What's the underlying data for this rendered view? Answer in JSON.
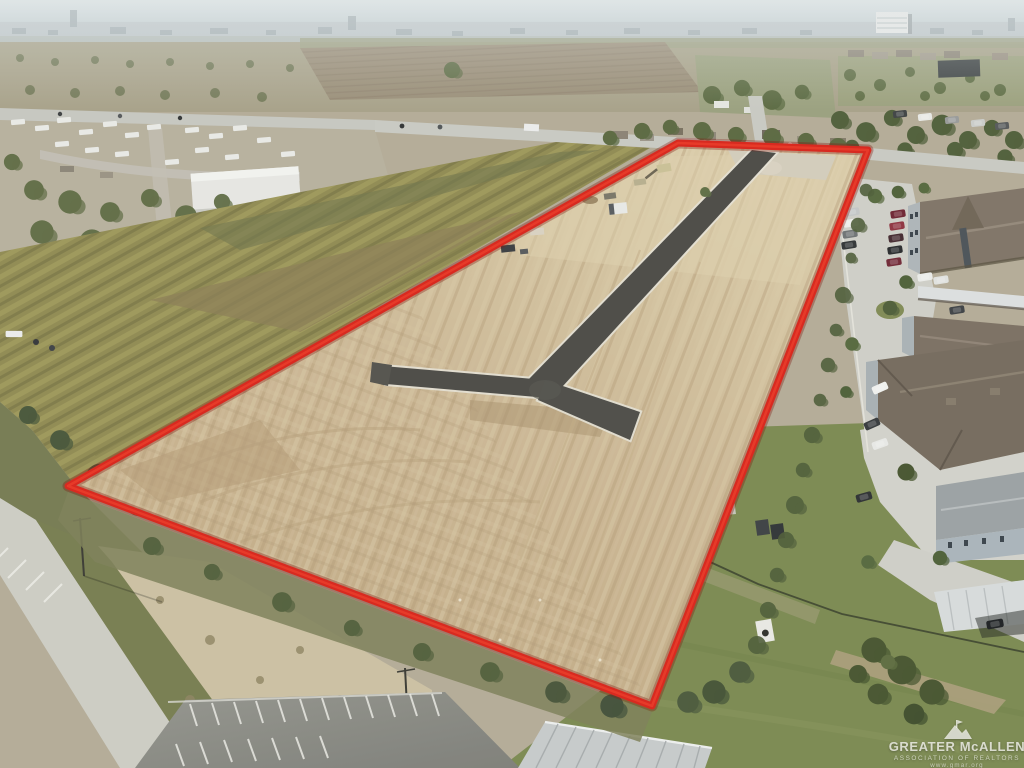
{
  "photo": {
    "description": "Aerial drone photograph of a cleared land parcel outlined in red with a new T-shaped asphalt street, bordered by an apartment complex on the right, an RV park and fields on the left, and a hazy city horizon.",
    "watermark": {
      "title": "GREATER McALLEN",
      "subtitle": "ASSOCIATION OF REALTORS",
      "url": "www.gmar.org"
    },
    "colors": {
      "boundary_red": "#d8231a",
      "dirt_tan": "#c9b592",
      "asphalt_dark": "#4a4945",
      "concrete_light": "#d0d0c9",
      "grass_green": "#7a8a52",
      "sky_haze": "#ccd4d8",
      "roof_brown": "#7b7063",
      "metal_roof_gray": "#c6cacb"
    }
  }
}
